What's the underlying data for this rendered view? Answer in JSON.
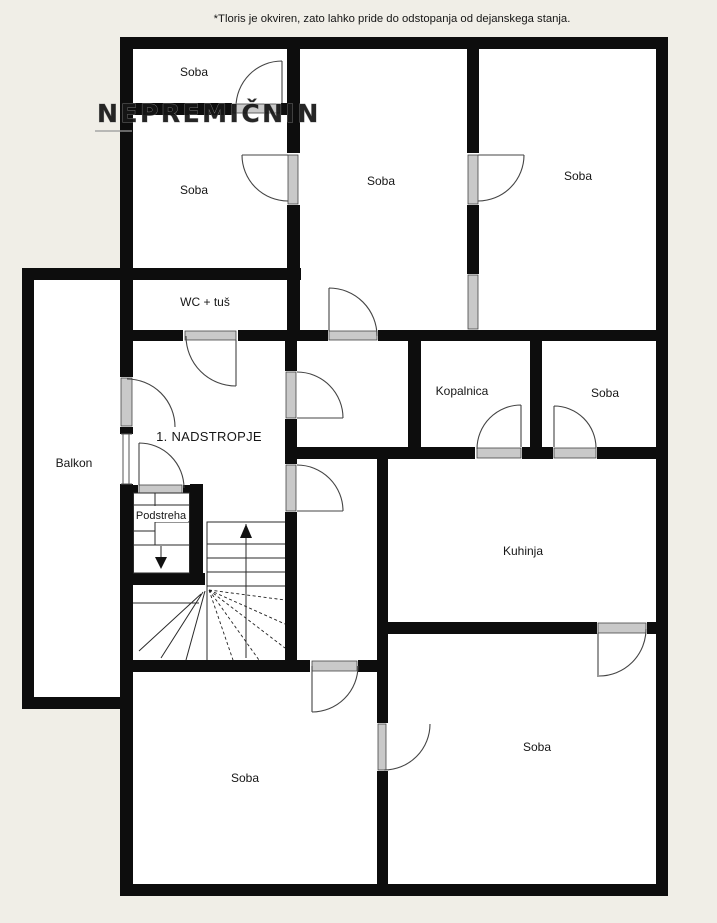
{
  "disclaimer": "*Tloris je okviren, zato lahko pride do odstopanja od dejanskega stanja.",
  "watermark": {
    "text": "NEPREMIČNIN"
  },
  "floor_label": "1. NADSTROPJE",
  "rooms": {
    "soba_top_left": "Soba",
    "soba_mid_left": "Soba",
    "soba_top_middle": "Soba",
    "soba_top_right": "Soba",
    "wc": "WC + tuš",
    "balkon": "Balkon",
    "podstreha": "Podstreha",
    "kopalnica": "Kopalnica",
    "soba_small": "Soba",
    "kuhinja": "Kuhinja",
    "soba_bottom_left": "Soba",
    "soba_bottom_right": "Soba"
  },
  "icons": {
    "stairs_up": "up-arrow",
    "stairs_down": "down-arrow"
  },
  "colors": {
    "background": "#f0eee7",
    "plan_fill": "#ffffff",
    "wall": "#0d0d0d",
    "door_sill": "#c9c9c9",
    "watermark_color": "#ffffff"
  }
}
